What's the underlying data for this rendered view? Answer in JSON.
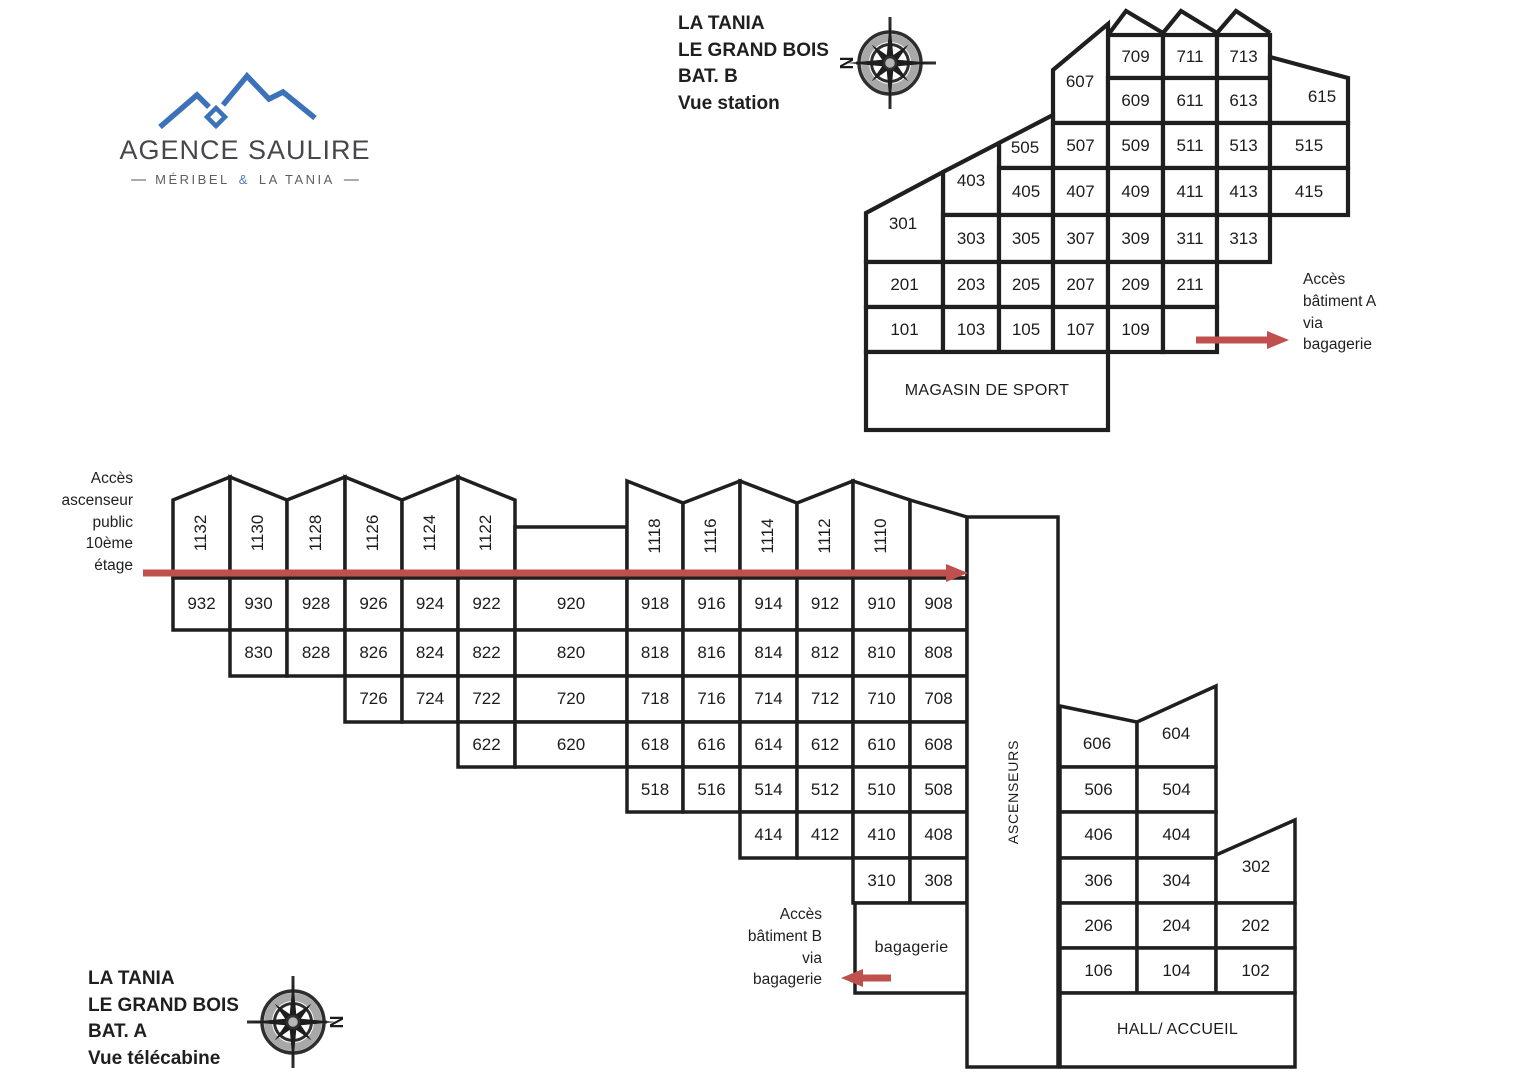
{
  "logo": {
    "name": "AGENCE SAULIRE",
    "dash": "—",
    "tagline_left": "MÉRIBEL",
    "tagline_amp": "&",
    "tagline_right": "LA TANIA"
  },
  "titles": {
    "b": [
      "LA TANIA",
      "LE GRAND BOIS",
      "BAT. B",
      "Vue station"
    ],
    "a": [
      "LA TANIA",
      "LE GRAND BOIS",
      "BAT. A",
      "Vue télécabine"
    ]
  },
  "notes": {
    "access_a": [
      "Accès",
      "bâtiment A",
      "via",
      "bagagerie"
    ],
    "access_b": [
      "Accès",
      "bâtiment B",
      "via",
      "bagagerie"
    ],
    "lift": [
      "Accès",
      "ascenseur",
      "public",
      "10ème",
      "étage"
    ]
  },
  "compass": {
    "n": "N"
  },
  "colors": {
    "line": "#1f1f1f",
    "arrow": "#c0504d",
    "logo_blue": "#3c72b9",
    "room_fill": "#ffffff"
  },
  "building_b": {
    "rooms": [
      {
        "n": "709",
        "x": 1108,
        "y": 35,
        "w": 55,
        "h": 43
      },
      {
        "n": "711",
        "x": 1163,
        "y": 35,
        "w": 54,
        "h": 43
      },
      {
        "n": "713",
        "x": 1217,
        "y": 35,
        "w": 53,
        "h": 43
      },
      {
        "n": "607",
        "pts": [
          [
            1053,
            70
          ],
          [
            1108,
            24
          ],
          [
            1108,
            123
          ],
          [
            1053,
            123
          ]
        ],
        "lx": 1080,
        "ly": 82
      },
      {
        "n": "609",
        "x": 1108,
        "y": 78,
        "w": 55,
        "h": 45
      },
      {
        "n": "611",
        "x": 1163,
        "y": 78,
        "w": 54,
        "h": 45
      },
      {
        "n": "613",
        "x": 1217,
        "y": 78,
        "w": 53,
        "h": 45
      },
      {
        "n": "615",
        "pts": [
          [
            1270,
            57
          ],
          [
            1348,
            78
          ],
          [
            1348,
            123
          ],
          [
            1270,
            123
          ]
        ],
        "lx": 1322,
        "ly": 97
      },
      {
        "n": "505",
        "pts": [
          [
            999,
            143
          ],
          [
            1053,
            115
          ],
          [
            1053,
            168
          ],
          [
            999,
            168
          ]
        ],
        "lx": 1025,
        "ly": 148
      },
      {
        "n": "507",
        "x": 1053,
        "y": 123,
        "w": 55,
        "h": 45
      },
      {
        "n": "509",
        "x": 1108,
        "y": 123,
        "w": 55,
        "h": 45
      },
      {
        "n": "511",
        "x": 1163,
        "y": 123,
        "w": 54,
        "h": 45
      },
      {
        "n": "513",
        "x": 1217,
        "y": 123,
        "w": 53,
        "h": 45
      },
      {
        "n": "515",
        "x": 1270,
        "y": 123,
        "w": 78,
        "h": 45
      },
      {
        "n": "403",
        "pts": [
          [
            943,
            172
          ],
          [
            999,
            143
          ],
          [
            999,
            215
          ],
          [
            943,
            215
          ]
        ],
        "lx": 971,
        "ly": 181
      },
      {
        "n": "405",
        "x": 999,
        "y": 168,
        "w": 54,
        "h": 47
      },
      {
        "n": "407",
        "x": 1053,
        "y": 168,
        "w": 55,
        "h": 47
      },
      {
        "n": "409",
        "x": 1108,
        "y": 168,
        "w": 55,
        "h": 47
      },
      {
        "n": "411",
        "x": 1163,
        "y": 168,
        "w": 54,
        "h": 47
      },
      {
        "n": "413",
        "x": 1217,
        "y": 168,
        "w": 53,
        "h": 47
      },
      {
        "n": "415",
        "x": 1270,
        "y": 168,
        "w": 78,
        "h": 47
      },
      {
        "n": "301",
        "pts": [
          [
            866,
            213
          ],
          [
            943,
            172
          ],
          [
            943,
            262
          ],
          [
            866,
            262
          ]
        ],
        "lx": 903,
        "ly": 224
      },
      {
        "n": "303",
        "x": 943,
        "y": 215,
        "w": 56,
        "h": 47
      },
      {
        "n": "305",
        "x": 999,
        "y": 215,
        "w": 54,
        "h": 47
      },
      {
        "n": "307",
        "x": 1053,
        "y": 215,
        "w": 55,
        "h": 47
      },
      {
        "n": "309",
        "x": 1108,
        "y": 215,
        "w": 55,
        "h": 47
      },
      {
        "n": "311",
        "x": 1163,
        "y": 215,
        "w": 54,
        "h": 47
      },
      {
        "n": "313",
        "x": 1217,
        "y": 215,
        "w": 53,
        "h": 47
      },
      {
        "n": "201",
        "x": 866,
        "y": 262,
        "w": 77,
        "h": 45
      },
      {
        "n": "203",
        "x": 943,
        "y": 262,
        "w": 56,
        "h": 45
      },
      {
        "n": "205",
        "x": 999,
        "y": 262,
        "w": 54,
        "h": 45
      },
      {
        "n": "207",
        "x": 1053,
        "y": 262,
        "w": 55,
        "h": 45
      },
      {
        "n": "209",
        "x": 1108,
        "y": 262,
        "w": 55,
        "h": 45
      },
      {
        "n": "211",
        "x": 1163,
        "y": 262,
        "w": 54,
        "h": 45
      },
      {
        "n": "101",
        "x": 866,
        "y": 307,
        "w": 77,
        "h": 45
      },
      {
        "n": "103",
        "x": 943,
        "y": 307,
        "w": 56,
        "h": 45
      },
      {
        "n": "105",
        "x": 999,
        "y": 307,
        "w": 54,
        "h": 45
      },
      {
        "n": "107",
        "x": 1053,
        "y": 307,
        "w": 55,
        "h": 45
      },
      {
        "n": "109",
        "x": 1108,
        "y": 307,
        "w": 55,
        "h": 45
      },
      {
        "n": "",
        "x": 1163,
        "y": 307,
        "w": 54,
        "h": 45
      },
      {
        "n": "MAGASIN DE SPORT",
        "x": 866,
        "y": 352,
        "w": 242,
        "h": 78,
        "big": 1
      }
    ]
  },
  "building_a": {
    "rooms": [
      {
        "n": "1132",
        "pts": [
          [
            173,
            500
          ],
          [
            230,
            477
          ],
          [
            230,
            578
          ],
          [
            173,
            578
          ]
        ],
        "rot": 1,
        "lx": 201,
        "ly": 533
      },
      {
        "n": "1130",
        "pts": [
          [
            230,
            477
          ],
          [
            287,
            500
          ],
          [
            287,
            578
          ],
          [
            230,
            578
          ]
        ],
        "rot": 1,
        "lx": 258,
        "ly": 533
      },
      {
        "n": "1128",
        "pts": [
          [
            287,
            500
          ],
          [
            345,
            477
          ],
          [
            345,
            578
          ],
          [
            287,
            578
          ]
        ],
        "rot": 1,
        "lx": 316,
        "ly": 533
      },
      {
        "n": "1126",
        "pts": [
          [
            345,
            477
          ],
          [
            402,
            500
          ],
          [
            402,
            578
          ],
          [
            345,
            578
          ]
        ],
        "rot": 1,
        "lx": 373,
        "ly": 533
      },
      {
        "n": "1124",
        "pts": [
          [
            402,
            500
          ],
          [
            458,
            477
          ],
          [
            458,
            578
          ],
          [
            402,
            578
          ]
        ],
        "rot": 1,
        "lx": 430,
        "ly": 533
      },
      {
        "n": "1122",
        "pts": [
          [
            458,
            477
          ],
          [
            515,
            500
          ],
          [
            515,
            578
          ],
          [
            458,
            578
          ]
        ],
        "rot": 1,
        "lx": 486,
        "ly": 533
      },
      {
        "n": "",
        "x": 515,
        "y": 527,
        "w": 112,
        "h": 51
      },
      {
        "n": "1118",
        "pts": [
          [
            627,
            481
          ],
          [
            683,
            503
          ],
          [
            683,
            578
          ],
          [
            627,
            578
          ]
        ],
        "rot": 1,
        "lx": 655,
        "ly": 536
      },
      {
        "n": "1116",
        "pts": [
          [
            683,
            503
          ],
          [
            740,
            481
          ],
          [
            740,
            578
          ],
          [
            683,
            578
          ]
        ],
        "rot": 1,
        "lx": 711,
        "ly": 536
      },
      {
        "n": "1114",
        "pts": [
          [
            740,
            481
          ],
          [
            797,
            503
          ],
          [
            797,
            578
          ],
          [
            740,
            578
          ]
        ],
        "rot": 1,
        "lx": 768,
        "ly": 536
      },
      {
        "n": "1112",
        "pts": [
          [
            797,
            503
          ],
          [
            853,
            481
          ],
          [
            853,
            578
          ],
          [
            797,
            578
          ]
        ],
        "rot": 1,
        "lx": 825,
        "ly": 536
      },
      {
        "n": "1110",
        "pts": [
          [
            853,
            481
          ],
          [
            910,
            500
          ],
          [
            910,
            578
          ],
          [
            853,
            578
          ]
        ],
        "rot": 1,
        "lx": 881,
        "ly": 536
      },
      {
        "n": "",
        "pts": [
          [
            910,
            500
          ],
          [
            967,
            517
          ],
          [
            967,
            578
          ],
          [
            910,
            578
          ]
        ]
      },
      {
        "n": "932",
        "x": 173,
        "y": 578,
        "w": 57,
        "h": 52
      },
      {
        "n": "930",
        "x": 230,
        "y": 578,
        "w": 57,
        "h": 52
      },
      {
        "n": "928",
        "x": 287,
        "y": 578,
        "w": 58,
        "h": 52
      },
      {
        "n": "926",
        "x": 345,
        "y": 578,
        "w": 57,
        "h": 52
      },
      {
        "n": "924",
        "x": 402,
        "y": 578,
        "w": 56,
        "h": 52
      },
      {
        "n": "922",
        "x": 458,
        "y": 578,
        "w": 57,
        "h": 52
      },
      {
        "n": "920",
        "x": 515,
        "y": 578,
        "w": 112,
        "h": 52
      },
      {
        "n": "918",
        "x": 627,
        "y": 578,
        "w": 56,
        "h": 52
      },
      {
        "n": "916",
        "x": 683,
        "y": 578,
        "w": 57,
        "h": 52
      },
      {
        "n": "914",
        "x": 740,
        "y": 578,
        "w": 57,
        "h": 52
      },
      {
        "n": "912",
        "x": 797,
        "y": 578,
        "w": 56,
        "h": 52
      },
      {
        "n": "910",
        "x": 853,
        "y": 578,
        "w": 57,
        "h": 52
      },
      {
        "n": "908",
        "x": 910,
        "y": 578,
        "w": 57,
        "h": 52
      },
      {
        "n": "830",
        "x": 230,
        "y": 630,
        "w": 57,
        "h": 46
      },
      {
        "n": "828",
        "x": 287,
        "y": 630,
        "w": 58,
        "h": 46
      },
      {
        "n": "826",
        "x": 345,
        "y": 630,
        "w": 57,
        "h": 46
      },
      {
        "n": "824",
        "x": 402,
        "y": 630,
        "w": 56,
        "h": 46
      },
      {
        "n": "822",
        "x": 458,
        "y": 630,
        "w": 57,
        "h": 46
      },
      {
        "n": "820",
        "x": 515,
        "y": 630,
        "w": 112,
        "h": 46
      },
      {
        "n": "818",
        "x": 627,
        "y": 630,
        "w": 56,
        "h": 46
      },
      {
        "n": "816",
        "x": 683,
        "y": 630,
        "w": 57,
        "h": 46
      },
      {
        "n": "814",
        "x": 740,
        "y": 630,
        "w": 57,
        "h": 46
      },
      {
        "n": "812",
        "x": 797,
        "y": 630,
        "w": 56,
        "h": 46
      },
      {
        "n": "810",
        "x": 853,
        "y": 630,
        "w": 57,
        "h": 46
      },
      {
        "n": "808",
        "x": 910,
        "y": 630,
        "w": 57,
        "h": 46
      },
      {
        "n": "726",
        "x": 345,
        "y": 676,
        "w": 57,
        "h": 46
      },
      {
        "n": "724",
        "x": 402,
        "y": 676,
        "w": 56,
        "h": 46
      },
      {
        "n": "722",
        "x": 458,
        "y": 676,
        "w": 57,
        "h": 46
      },
      {
        "n": "720",
        "x": 515,
        "y": 676,
        "w": 112,
        "h": 46
      },
      {
        "n": "718",
        "x": 627,
        "y": 676,
        "w": 56,
        "h": 46
      },
      {
        "n": "716",
        "x": 683,
        "y": 676,
        "w": 57,
        "h": 46
      },
      {
        "n": "714",
        "x": 740,
        "y": 676,
        "w": 57,
        "h": 46
      },
      {
        "n": "712",
        "x": 797,
        "y": 676,
        "w": 56,
        "h": 46
      },
      {
        "n": "710",
        "x": 853,
        "y": 676,
        "w": 57,
        "h": 46
      },
      {
        "n": "708",
        "x": 910,
        "y": 676,
        "w": 57,
        "h": 46
      },
      {
        "n": "622",
        "x": 458,
        "y": 722,
        "w": 57,
        "h": 45
      },
      {
        "n": "620",
        "x": 515,
        "y": 722,
        "w": 112,
        "h": 45
      },
      {
        "n": "618",
        "x": 627,
        "y": 722,
        "w": 56,
        "h": 45
      },
      {
        "n": "616",
        "x": 683,
        "y": 722,
        "w": 57,
        "h": 45
      },
      {
        "n": "614",
        "x": 740,
        "y": 722,
        "w": 57,
        "h": 45
      },
      {
        "n": "612",
        "x": 797,
        "y": 722,
        "w": 56,
        "h": 45
      },
      {
        "n": "610",
        "x": 853,
        "y": 722,
        "w": 57,
        "h": 45
      },
      {
        "n": "608",
        "x": 910,
        "y": 722,
        "w": 57,
        "h": 45
      },
      {
        "n": "518",
        "x": 627,
        "y": 767,
        "w": 56,
        "h": 45
      },
      {
        "n": "516",
        "x": 683,
        "y": 767,
        "w": 57,
        "h": 45
      },
      {
        "n": "514",
        "x": 740,
        "y": 767,
        "w": 57,
        "h": 45
      },
      {
        "n": "512",
        "x": 797,
        "y": 767,
        "w": 56,
        "h": 45
      },
      {
        "n": "510",
        "x": 853,
        "y": 767,
        "w": 57,
        "h": 45
      },
      {
        "n": "508",
        "x": 910,
        "y": 767,
        "w": 57,
        "h": 45
      },
      {
        "n": "414",
        "x": 740,
        "y": 812,
        "w": 57,
        "h": 46
      },
      {
        "n": "412",
        "x": 797,
        "y": 812,
        "w": 56,
        "h": 46
      },
      {
        "n": "410",
        "x": 853,
        "y": 812,
        "w": 57,
        "h": 46
      },
      {
        "n": "408",
        "x": 910,
        "y": 812,
        "w": 57,
        "h": 46
      },
      {
        "n": "310",
        "x": 853,
        "y": 858,
        "w": 57,
        "h": 45
      },
      {
        "n": "308",
        "x": 910,
        "y": 858,
        "w": 57,
        "h": 45
      },
      {
        "n": "bagagerie",
        "x": 855,
        "y": 903,
        "w": 113,
        "h": 90,
        "big": 1
      },
      {
        "n": "ASCENSEURS",
        "x": 967,
        "y": 517,
        "w": 91,
        "h": 550,
        "rot": 1,
        "big": 1
      },
      {
        "n": "606",
        "pts": [
          [
            1060,
            706
          ],
          [
            1137,
            722
          ],
          [
            1137,
            767
          ],
          [
            1060,
            767
          ]
        ],
        "lx": 1097,
        "ly": 744
      },
      {
        "n": "604",
        "pts": [
          [
            1137,
            722
          ],
          [
            1216,
            686
          ],
          [
            1216,
            767
          ],
          [
            1137,
            767
          ]
        ],
        "lx": 1176,
        "ly": 734
      },
      {
        "n": "506",
        "x": 1060,
        "y": 767,
        "w": 77,
        "h": 45
      },
      {
        "n": "504",
        "x": 1137,
        "y": 767,
        "w": 79,
        "h": 45
      },
      {
        "n": "406",
        "x": 1060,
        "y": 812,
        "w": 77,
        "h": 46
      },
      {
        "n": "404",
        "x": 1137,
        "y": 812,
        "w": 79,
        "h": 46
      },
      {
        "n": "306",
        "x": 1060,
        "y": 858,
        "w": 77,
        "h": 45
      },
      {
        "n": "304",
        "x": 1137,
        "y": 858,
        "w": 79,
        "h": 45
      },
      {
        "n": "302",
        "pts": [
          [
            1216,
            855
          ],
          [
            1295,
            820
          ],
          [
            1295,
            903
          ],
          [
            1216,
            903
          ]
        ],
        "lx": 1256,
        "ly": 867
      },
      {
        "n": "206",
        "x": 1060,
        "y": 903,
        "w": 77,
        "h": 45
      },
      {
        "n": "204",
        "x": 1137,
        "y": 903,
        "w": 79,
        "h": 45
      },
      {
        "n": "202",
        "x": 1216,
        "y": 903,
        "w": 79,
        "h": 45
      },
      {
        "n": "106",
        "x": 1060,
        "y": 948,
        "w": 77,
        "h": 45
      },
      {
        "n": "104",
        "x": 1137,
        "y": 948,
        "w": 79,
        "h": 45
      },
      {
        "n": "102",
        "x": 1216,
        "y": 948,
        "w": 79,
        "h": 45
      },
      {
        "n": "HALL/ ACCUEIL",
        "x": 1060,
        "y": 993,
        "w": 235,
        "h": 74,
        "big": 1
      }
    ]
  },
  "arrows": [
    {
      "name": "access-elevator-arrow",
      "y": 573,
      "x1": 143,
      "x2": 946,
      "dir": "right"
    },
    {
      "name": "access-batiment-a-arrow",
      "y": 340,
      "x1": 1196,
      "x2": 1267,
      "dir": "right"
    },
    {
      "name": "access-batiment-b-arrow",
      "y": 978,
      "x1": 891,
      "x2": 863,
      "dir": "left"
    }
  ]
}
